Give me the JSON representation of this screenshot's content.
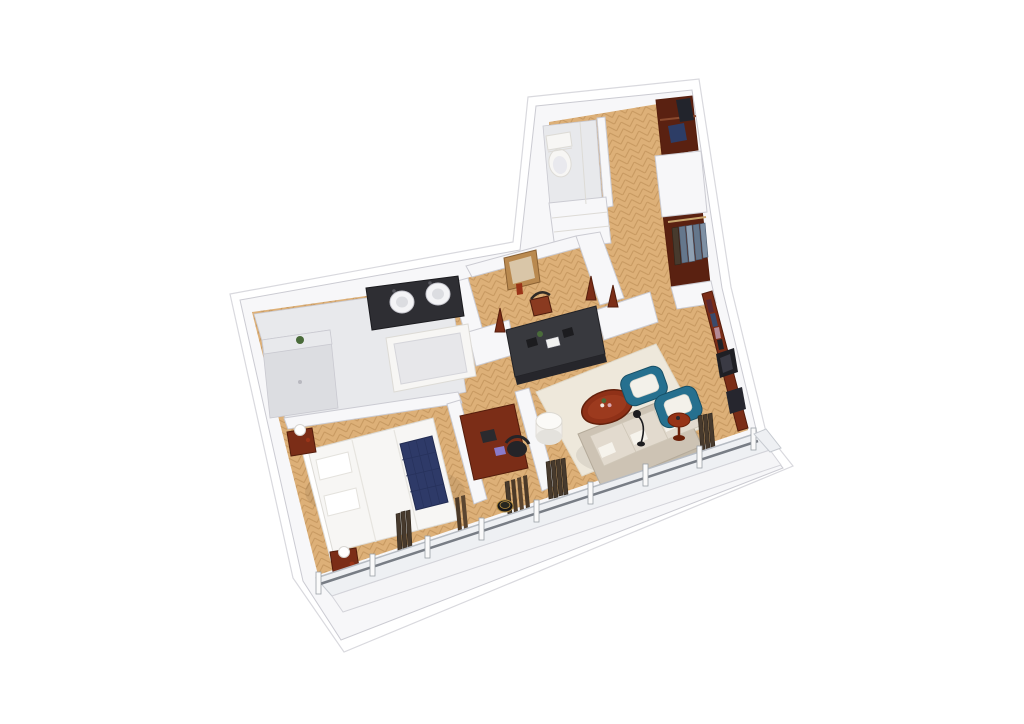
{
  "scene": {
    "title": "isometric-3d-apartment-floorplan-render",
    "background": "#ffffff",
    "palette": {
      "background": "#ffffff",
      "wall": "#f7f7f9",
      "wall_line": "#cbcbd2",
      "slab_line": "#d9d9de",
      "wood": "#ddb078",
      "wood_seam": "rgba(146,96,40,0.30)",
      "marble": "#e8e9ec",
      "marble_dark": "#dcdde1",
      "marble_edge": "#c9c9d0",
      "glass": "#eef0f3",
      "glass_frame": "#c6cad0",
      "rail": "#787d85",
      "mullion": "#fafafa",
      "mullion_edge": "#9aa0a6",
      "closet_dark": "#5a2111",
      "mahogany": "#7b2d17",
      "mahogany_dark": "#551d0c",
      "table_red": "#8f3118",
      "table_red_light": "#9c3a1e",
      "teal": "#26708f",
      "teal_dark": "#174f66",
      "sofa": "#cdc3b4",
      "sofa_back": "#c3b9a8",
      "sofa_edge": "#b5ab9b",
      "cushion": "#e2dace",
      "cushion_edge": "#cfc7b8",
      "rug": "#eee8db",
      "rug_edge": "#e0d9c9",
      "navy": "#2e3a68",
      "navy_dark": "#222c52",
      "black": "#1c1c1f",
      "console_gray": "#38393e",
      "console_gray_dark": "#26262b",
      "curtain": "#473a2d",
      "curtain_dark": "#2f261c",
      "brass": "#b08a3e",
      "mirror_frame": "#b9894f",
      "mirror_glass": "#d9c6a8",
      "plant": "#4a6b3a",
      "white_furniture": "#f7f6f4",
      "white_furniture_edge": "#dddbd6",
      "shirt_blue": "#7e90a4",
      "shirt_blue_dark": "#65778c",
      "book_red": "#5a2a33",
      "book_blue": "#3a4a6b",
      "book_pink": "#b48a96"
    },
    "rooms": [
      {
        "id": "entry-hall",
        "floor": "herringbone-wood"
      },
      {
        "id": "powder-room",
        "floor": "marble"
      },
      {
        "id": "wardrobe-closet-upper",
        "floor": "dark-wood"
      },
      {
        "id": "wardrobe-closet-lower",
        "floor": "dark-wood"
      },
      {
        "id": "corridor-dressing-area",
        "floor": "herringbone-wood"
      },
      {
        "id": "bathroom",
        "floor": "marble"
      },
      {
        "id": "bedroom",
        "floor": "herringbone-wood"
      },
      {
        "id": "desk-nook",
        "floor": "herringbone-wood"
      },
      {
        "id": "living-room",
        "floor": "herringbone-wood"
      },
      {
        "id": "window-facade",
        "floor": "glass-band"
      }
    ],
    "furniture": [
      "toilet",
      "powder-cabinet",
      "hall-dresser",
      "duffel-bag",
      "hanging-shirts",
      "double-sink-vanity",
      "bathtub",
      "walk-in-shower",
      "shower-plant",
      "console-mirror",
      "corridor-chair",
      "candle-stands",
      "tv-media-console",
      "bed",
      "pillows",
      "navy-tufted-throw",
      "nightstand-left",
      "nightstand-right",
      "table-lamps",
      "writing-desk",
      "desk-chair",
      "desk-notebook",
      "laptop",
      "barrel-stool",
      "louver-panels",
      "area-rug",
      "three-seat-sofa",
      "seat-cushions",
      "round-coffee-table",
      "flower-vase",
      "teal-armchair-left",
      "teal-armchair-right",
      "cylinder-side-table",
      "red-side-table",
      "floor-lamp",
      "wall-shelf-console",
      "books-row",
      "leaning-art-frames",
      "window-mullions",
      "window-rail",
      "curtain-bundles"
    ]
  }
}
